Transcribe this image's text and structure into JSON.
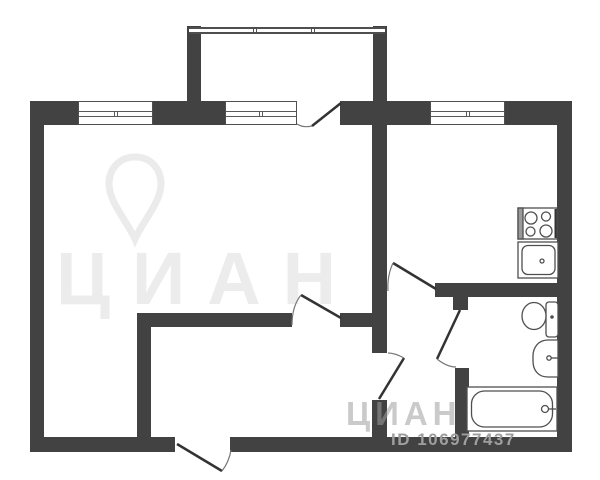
{
  "document": {
    "type": "apartment floor plan",
    "listing_id": "ID 106977437"
  },
  "watermarks": {
    "center_text": "ЦИАН",
    "bottom_text": "ЦИАН",
    "listing_id_label": "ID 106977437",
    "logo": "map-pin-watermark"
  },
  "colors": {
    "wall": "#424242",
    "thin_line": "#4f4f4f",
    "watermark_gray": "#9e9e9e",
    "background": "#ffffff"
  },
  "icons": {
    "stove": "stove-icon",
    "kitchen_sink": "kitchen-sink-icon",
    "toilet": "toilet-icon",
    "washbasin": "washbasin-icon",
    "bathtub": "bathtub-icon",
    "logo_pin": "map-pin-icon"
  },
  "plan_elements": {
    "rooms": [
      "living-room",
      "entrance-hall",
      "corridor",
      "kitchen",
      "bathroom",
      "balcony"
    ],
    "windows_count": 3,
    "doors_count": 6
  }
}
